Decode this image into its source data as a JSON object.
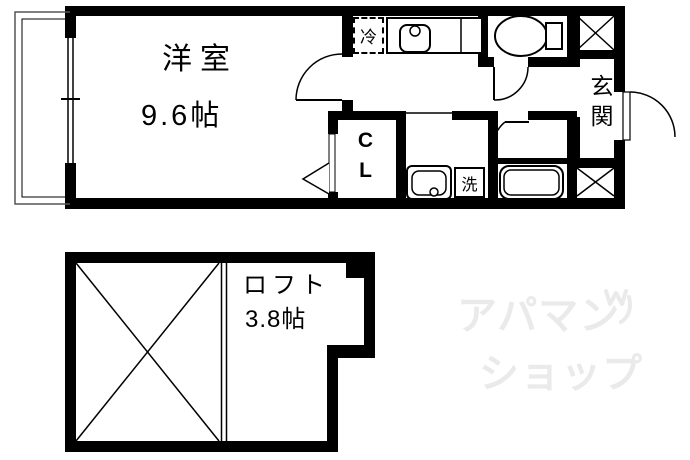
{
  "upper_plan": {
    "room_name": "洋室",
    "room_size": "9.6帖",
    "refrigerator": "冷",
    "closet": "CL",
    "washing_machine": "洗",
    "entrance": "玄関"
  },
  "loft_plan": {
    "room_name": "ロフト",
    "room_size": "3.8帖"
  },
  "watermark": {
    "line1": "アパマン",
    "line2": "ショップ",
    "color": "#eaeaea"
  },
  "colors": {
    "wall": "#000000",
    "line": "#000000",
    "background": "#ffffff"
  }
}
